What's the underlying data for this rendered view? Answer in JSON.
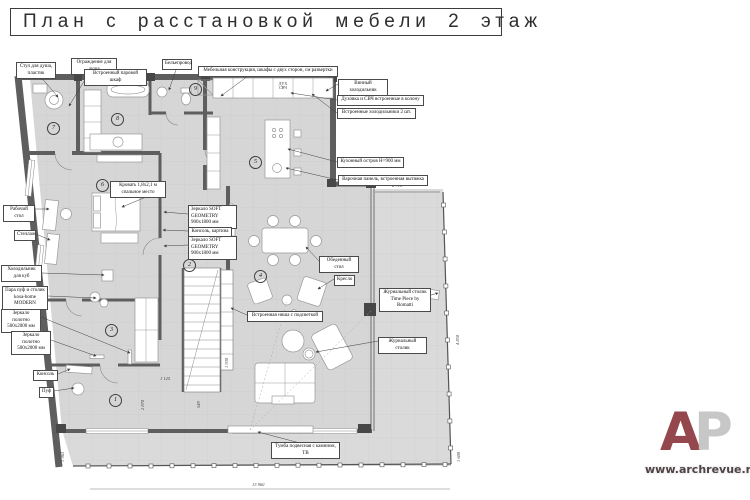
{
  "title": "План с расстановкой мебели 2 этаж",
  "colors": {
    "floor": "#d6d6d6",
    "terrace_floor": "#dadada",
    "wall": "#5e5e5e",
    "column": "#474747",
    "logo_accent": "#94474d",
    "logo_secondary": "#c7c7c7"
  },
  "rooms": [
    "1",
    "2",
    "3",
    "4",
    "5",
    "6",
    "7",
    "8",
    "9"
  ],
  "callouts": [
    {
      "text": "Стул для душа, пластик"
    },
    {
      "text": "Ограждение для душа"
    },
    {
      "text": "Встроенный паровой шкаф"
    },
    {
      "text": "Бельепровод"
    },
    {
      "text": "Мебельная конструкция, шкафы с двух сторон, см развертки"
    },
    {
      "text": "Винный холодильник"
    },
    {
      "text": "Духовка и СВЧ встроенные в колону"
    },
    {
      "text": "Встроенные холодильники 2 шт."
    },
    {
      "text": "Кухонный остров Н=900 мм"
    },
    {
      "text": "Варочная панель, встроенная вытяжка"
    },
    {
      "text": "Кровать 1,8х2,1 м спальное место"
    },
    {
      "text": "Зеркало SOFT GEOMETRY 900х1800 мм"
    },
    {
      "text": "Консоль, картина"
    },
    {
      "text": "Зеркало SOFT GEOMETRY 900х1800 мм"
    },
    {
      "text": "Обеденный стол"
    },
    {
      "text": "Кресло"
    },
    {
      "text": "Журнальный столик Time Piece by Romatti"
    },
    {
      "text": "Журнальный столик"
    },
    {
      "text": "Встроенная ниша с подсветкой"
    },
    {
      "text": "Рабочий стол"
    },
    {
      "text": "Стеллаж"
    },
    {
      "text": "Холодильник для куб"
    },
    {
      "text": "Пара пуф и столик kosa-home MODERN"
    },
    {
      "text": "Зеркало полотно 500х2000 мм"
    },
    {
      "text": "Зеркало полотно 500х2000 мм"
    },
    {
      "text": "Консоль"
    },
    {
      "text": "Пуф"
    },
    {
      "text": "Тумба подвесная с камином, ТВ"
    }
  ],
  "dims": {
    "terrace_top": "2 710",
    "right_side": "4 850",
    "right_bottom": "1 600",
    "bottom": "13 960",
    "left_bottom": "1 363",
    "stairs": "1 125",
    "stairs_side": "1 930",
    "hall_side": "2 870",
    "landing": "549"
  },
  "kitchen_unit": {
    "line1": "ДУХ",
    "line2": "СВЧ"
  },
  "logo": {
    "letter_a": "А",
    "letter_p": "Р",
    "url": "www.archrevue.ru"
  }
}
